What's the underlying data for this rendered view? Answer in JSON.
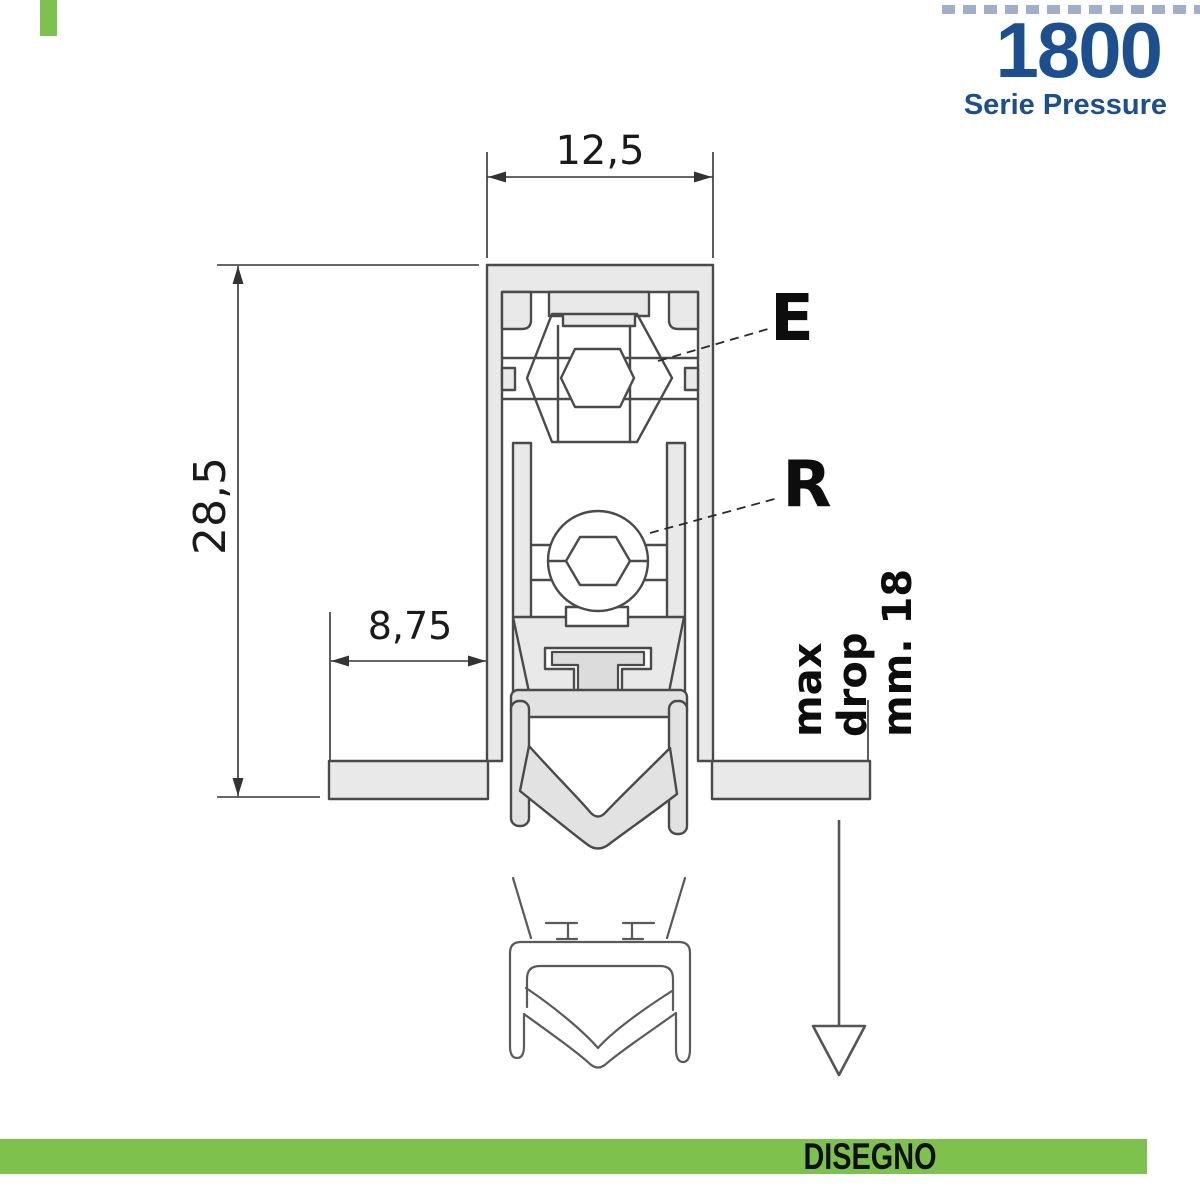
{
  "header": {
    "series_number": "1800",
    "series_name": "Serie Pressure"
  },
  "drawing": {
    "dim_width": "12,5",
    "dim_height": "28,5",
    "dim_flange": "8,75",
    "label_e": "E",
    "label_r": "R",
    "max_drop_line1": "max drop",
    "max_drop_line2": "mm. 18"
  },
  "footer": {
    "label": "DISEGNO"
  },
  "colors": {
    "accent_blue": "#1B4F8F",
    "accent_green": "#7EC24E",
    "line_dark": "#4A4A4A",
    "dim_line": "#333333",
    "fill_aluminium": "#E9E9E9",
    "fill_rubber": "#E2E2E2"
  }
}
